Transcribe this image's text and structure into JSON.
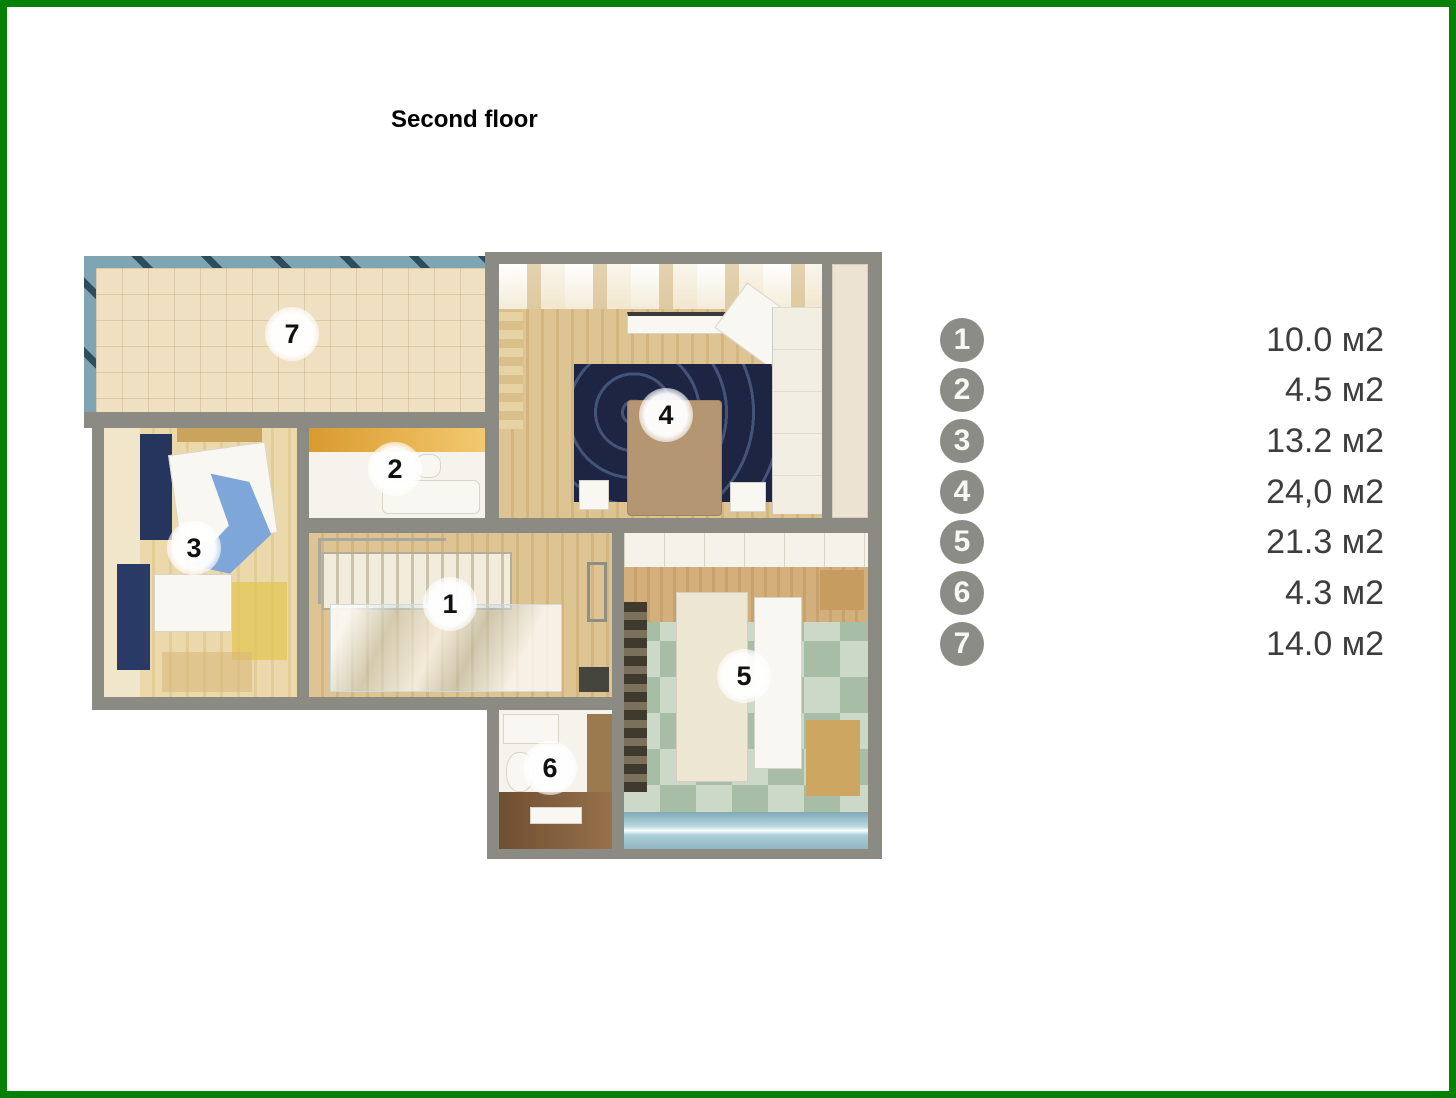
{
  "title": "Second floor",
  "rooms": [
    {
      "number": "1",
      "area": "10.0 м2"
    },
    {
      "number": "2",
      "area": "4.5 м2"
    },
    {
      "number": "3",
      "area": "13.2 м2"
    },
    {
      "number": "4",
      "area": "24,0 м2"
    },
    {
      "number": "5",
      "area": "21.3 м2"
    },
    {
      "number": "6",
      "area": "4.3 м2"
    },
    {
      "number": "7",
      "area": "14.0 м2"
    }
  ],
  "colors": {
    "frame_green": "#058205",
    "wall_gray": "#8b8b83",
    "railing_blue": "#7fa5b2",
    "terrace_floor": "#efe0c2",
    "wood_floor": "#d9bd8c",
    "rug_navy": "#1d2542",
    "checker_green": "#a8bda6",
    "window_glass": "#9fc4d0",
    "legend_circle": "#8c8c86",
    "area_text": "#3d3d3d"
  }
}
